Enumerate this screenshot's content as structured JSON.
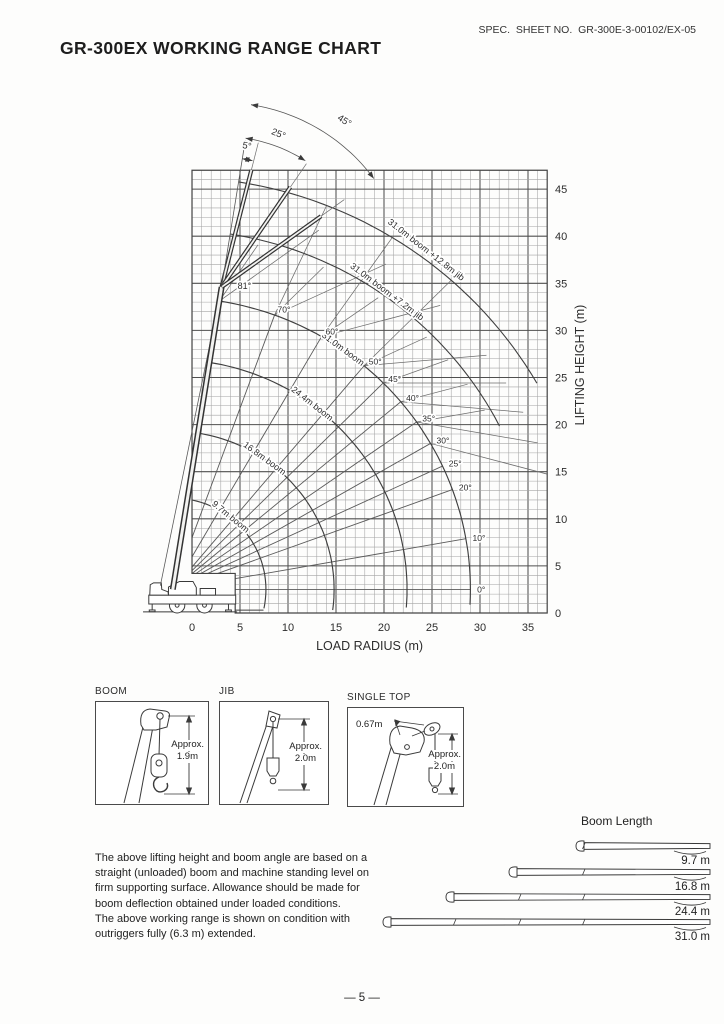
{
  "header": {
    "spec_no": "SPEC.  SHEET NO.  GR-300E-3-00102/EX-05",
    "title": "GR-300EX WORKING RANGE CHART"
  },
  "chart_data": {
    "type": "line",
    "title": "GR-300EX WORKING RANGE CHART",
    "xlabel": "LOAD RADIUS (m)",
    "ylabel": "LIFTING HEIGHT (m)",
    "x_ticks": [
      0,
      5,
      10,
      15,
      20,
      25,
      30,
      35
    ],
    "y_ticks": [
      0,
      5,
      10,
      15,
      20,
      25,
      30,
      35,
      40,
      45
    ],
    "xlim": [
      0,
      37
    ],
    "ylim": [
      0,
      47
    ],
    "grid": "on",
    "boom_angle_lines_deg": [
      0,
      10,
      20,
      25,
      30,
      35,
      40,
      45,
      50,
      60,
      70
    ],
    "max_boom_angle_deg": 81,
    "jib_offset_angles_deg": [
      5,
      25,
      45
    ],
    "series": [
      {
        "name": "9.7m boom",
        "boom_length_m": 9.7
      },
      {
        "name": "16.8m boom",
        "boom_length_m": 16.8
      },
      {
        "name": "24.4m boom",
        "boom_length_m": 24.4
      },
      {
        "name": "31.0m boom",
        "boom_length_m": 31.0
      },
      {
        "name": "31.0m boom +7.2m jib",
        "reach_m": 38.2,
        "jib_length_m": 7.2
      },
      {
        "name": "31.0m boom +12.8m jib",
        "reach_m": 43.8,
        "jib_length_m": 12.8
      }
    ]
  },
  "detail_boxes": [
    {
      "title": "BOOM",
      "approx_label": "Approx.",
      "value": "1.9m"
    },
    {
      "title": "JIB",
      "approx_label": "Approx.",
      "value": "2.0m"
    },
    {
      "title": "SINGLE TOP",
      "approx_label": "Approx.",
      "value": "2.0m",
      "offset_value": "0.67m"
    }
  ],
  "note": {
    "lines": [
      "The above lifting height and boom angle are based on a",
      "straight (unloaded) boom and machine standing level on",
      "firm supporting surface. Allowance should be made for",
      "boom deflection obtained under loaded conditions.",
      "The above working range is shown on condition with",
      "outriggers fully (6.3 m) extended."
    ]
  },
  "boom_length_section": {
    "title": "Boom Length",
    "items": [
      {
        "label": "9.7 m"
      },
      {
        "label": "16.8 m"
      },
      {
        "label": "24.4 m"
      },
      {
        "label": "31.0 m"
      }
    ]
  },
  "footer": {
    "page_number": "— 5 —"
  }
}
